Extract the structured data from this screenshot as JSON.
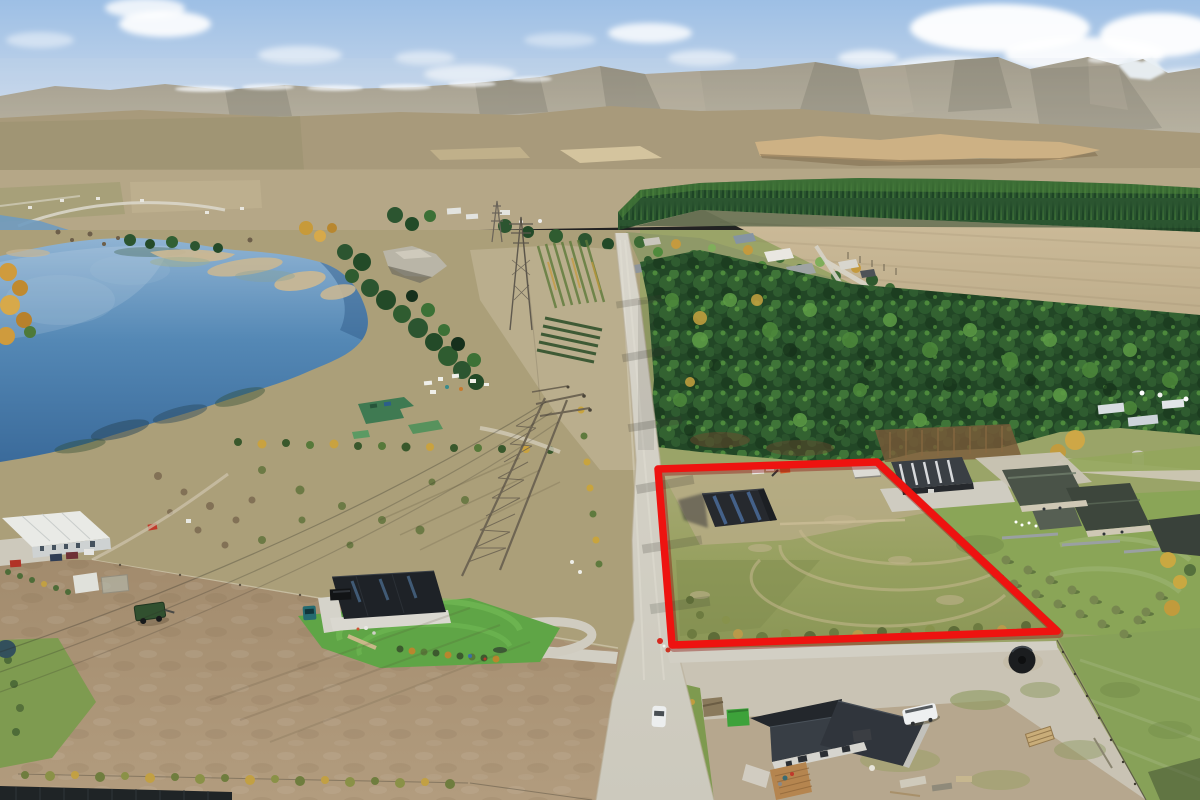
{
  "image": {
    "kind": "aerial-drone-photograph",
    "subject": "Rural lifestyle section outlined in red, beside a lake, pine plantation, gravel road and mountain ranges",
    "width": 1200,
    "height": 800
  },
  "boundary_overlay": {
    "label": "property-boundary",
    "points": "658,469 877,462 1057,631 672,645",
    "color": "#ee1310",
    "shadow_color": "#8a0f0a",
    "stroke_width": "7.5"
  },
  "palette": {
    "sky_top": "#9dbfe5",
    "sky_horizon": "#d3deec",
    "cloud": "#ffffff",
    "mountain": "#9a917c",
    "mountain_low": "#b3aa94",
    "snow": "#f2f5f8",
    "foothill": "#a89a7b",
    "cliff": "#cdb184",
    "valley_floor": "#b5a787",
    "forest_distant": "#2b5530",
    "forest_near": "#234a27",
    "field_tan": "#c9b896",
    "lake_light": "#8fb3d3",
    "lake_deep": "#3a6a9a",
    "sandbar": "#c8b795",
    "lot_grass": "#96a05f",
    "lot_dirt": "#b9ac88",
    "lawn_green": "#5fa546",
    "pasture_green": "#87a158",
    "paddock_dirt": "#a8937a",
    "gravel": "#d2cfc4",
    "roof_dark": "#2c3137",
    "shed_dark": "#26292e",
    "wall_light": "#d6d5cf",
    "tank_black": "#1b1d1f",
    "skip_green": "#3da23a",
    "van_white": "#eef0f1"
  },
  "landmarks": [
    {
      "name": "lake",
      "desc": "blue lake with tan sandbars, upper left"
    },
    {
      "name": "mountain-range",
      "desc": "snow-dusted ridgeline across the horizon"
    },
    {
      "name": "pine-plantation",
      "desc": "dense pine forest bands in middle distance and foreground right"
    },
    {
      "name": "outlined-lot",
      "desc": "red-outlined bare section containing a dark implement shed"
    },
    {
      "name": "transmission-towers",
      "desc": "high voltage lattice pylons along a cleared corridor"
    },
    {
      "name": "gravel-road",
      "desc": "gravel road running from foreground into the forest"
    },
    {
      "name": "construction-house",
      "desc": "new dark-roofed house under construction, bottom centre"
    },
    {
      "name": "black-house",
      "desc": "black dwelling with bright lawn, left foreground"
    },
    {
      "name": "neighbour-homestead",
      "desc": "large grey-roofed homestead with olive grove, right side"
    },
    {
      "name": "open-field",
      "desc": "large tan cleared field beyond the forest belt"
    },
    {
      "name": "campground",
      "desc": "green-roofed buildings and caravans near the lakeshore"
    },
    {
      "name": "water-tank",
      "desc": "round black water tank near the lot entrance"
    }
  ]
}
